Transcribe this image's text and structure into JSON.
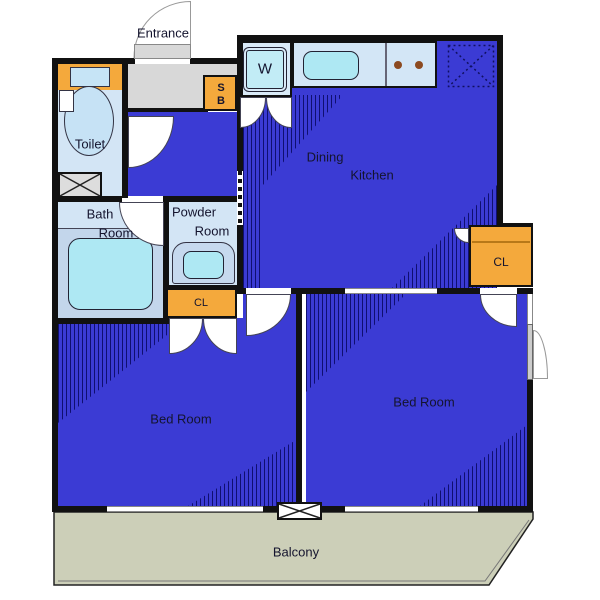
{
  "title": "apartment-floor-plan",
  "colors": {
    "blue": "#3b3bd4",
    "hatch": "#00004f",
    "lightblue": "#d3e5f5",
    "platform": "#c3d6eb",
    "cyan": "#aee8f3",
    "orange": "#f4a93c",
    "genkan": "#d8d8d8",
    "balcony": "#cccfb8",
    "wall": "#111111",
    "text": "#14142e"
  },
  "labels": {
    "entrance": "Entrance",
    "toilet": "Toilet",
    "bath": [
      "Bath",
      "Room"
    ],
    "powder": [
      "Powder",
      "Room"
    ],
    "dining": [
      "Dining",
      "Kitchen"
    ],
    "cl_left": "CL",
    "cl_right": "CL",
    "bed_left": "Bed Room",
    "bed_right": "Bed Room",
    "balcony": "Balcony",
    "washer": "W",
    "shoe_s": "S",
    "shoe_b": "B"
  },
  "icons": {
    "toilet_fixture": "toilet-bowl",
    "bathtub": "bathtub",
    "vanity": "vanity-sink",
    "kitchen_sink": "kitchen-sink",
    "burners": "stove-burners",
    "washer_pan": "washing-machine-pan",
    "refrigerator": "refrigerator-space-dotted-x",
    "pipe_space": "crossed-box",
    "door": "door-swing-arc"
  }
}
